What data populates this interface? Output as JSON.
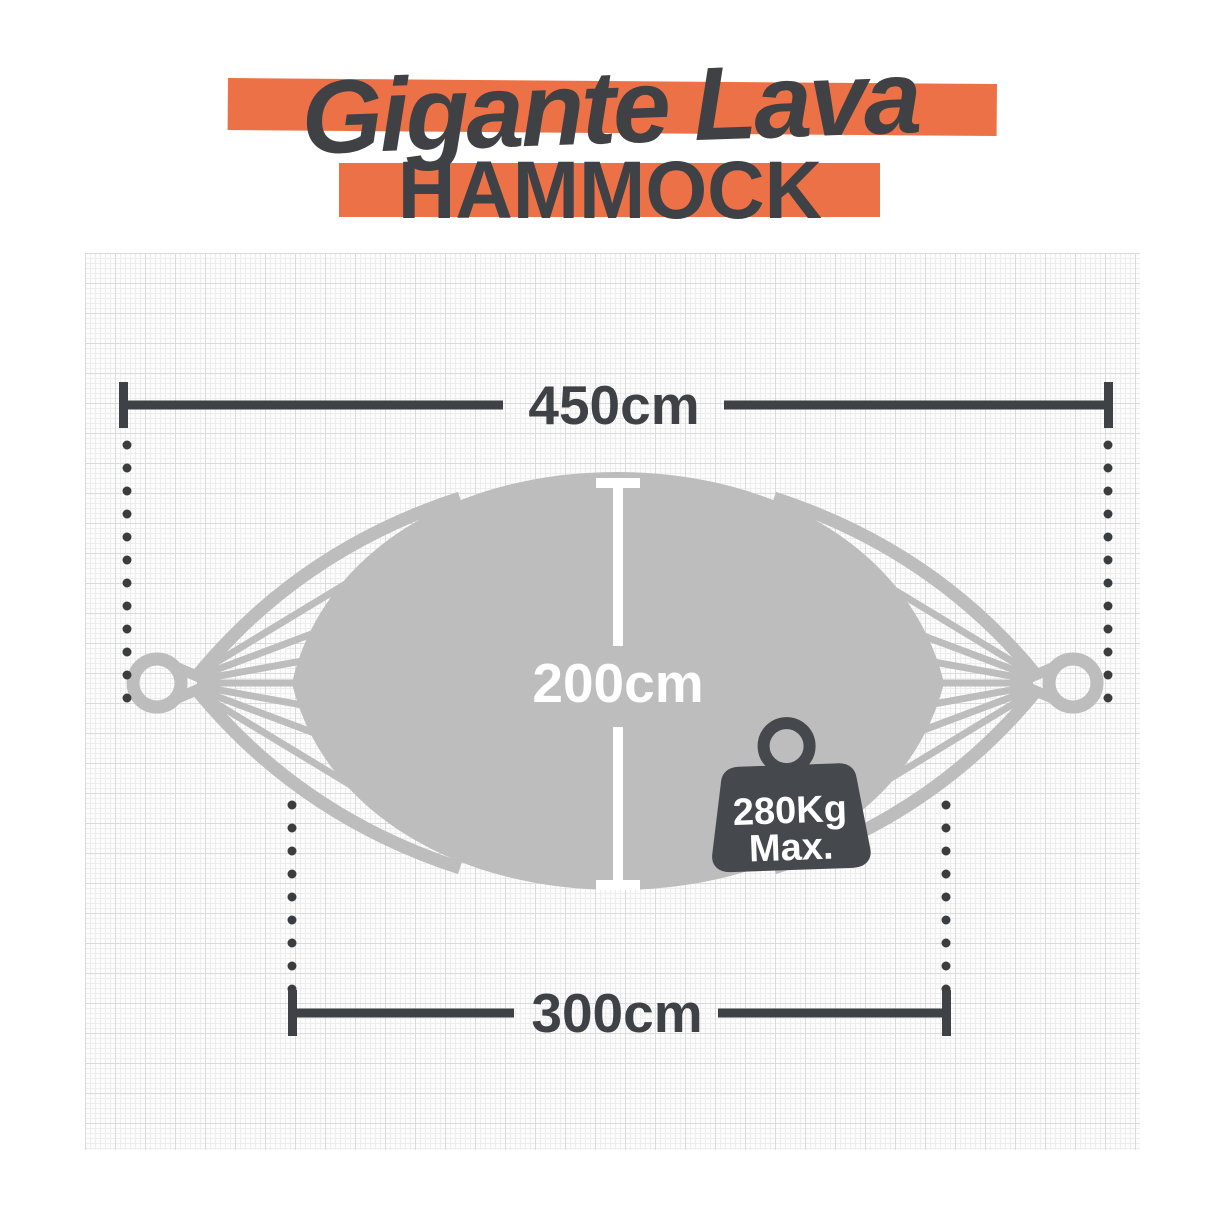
{
  "title": {
    "script_text": "Gigante Lava",
    "product_word": "HAMMOCK"
  },
  "diagram": {
    "total_length_label": "450cm",
    "width_label": "200cm",
    "bed_length_label": "300cm"
  },
  "weight_badge": {
    "line1": "280Kg",
    "line2": "Max."
  },
  "icons": {
    "weight_icon": "kettlebell-max-weight",
    "hammock_illustration": "hammock-top-view-with-rings"
  },
  "colors": {
    "accent_orange": "#ED7146",
    "ink_dark": "#3E4145",
    "hammock_gray": "#BDBDBD",
    "paper_white": "#FCFCFC",
    "grid_minor": "#EDEDED",
    "grid_major": "#DBDBDB",
    "dimension_white": "#FFFFFF",
    "weight_dark": "#45484C",
    "dot_dark": "#3A3D40"
  }
}
